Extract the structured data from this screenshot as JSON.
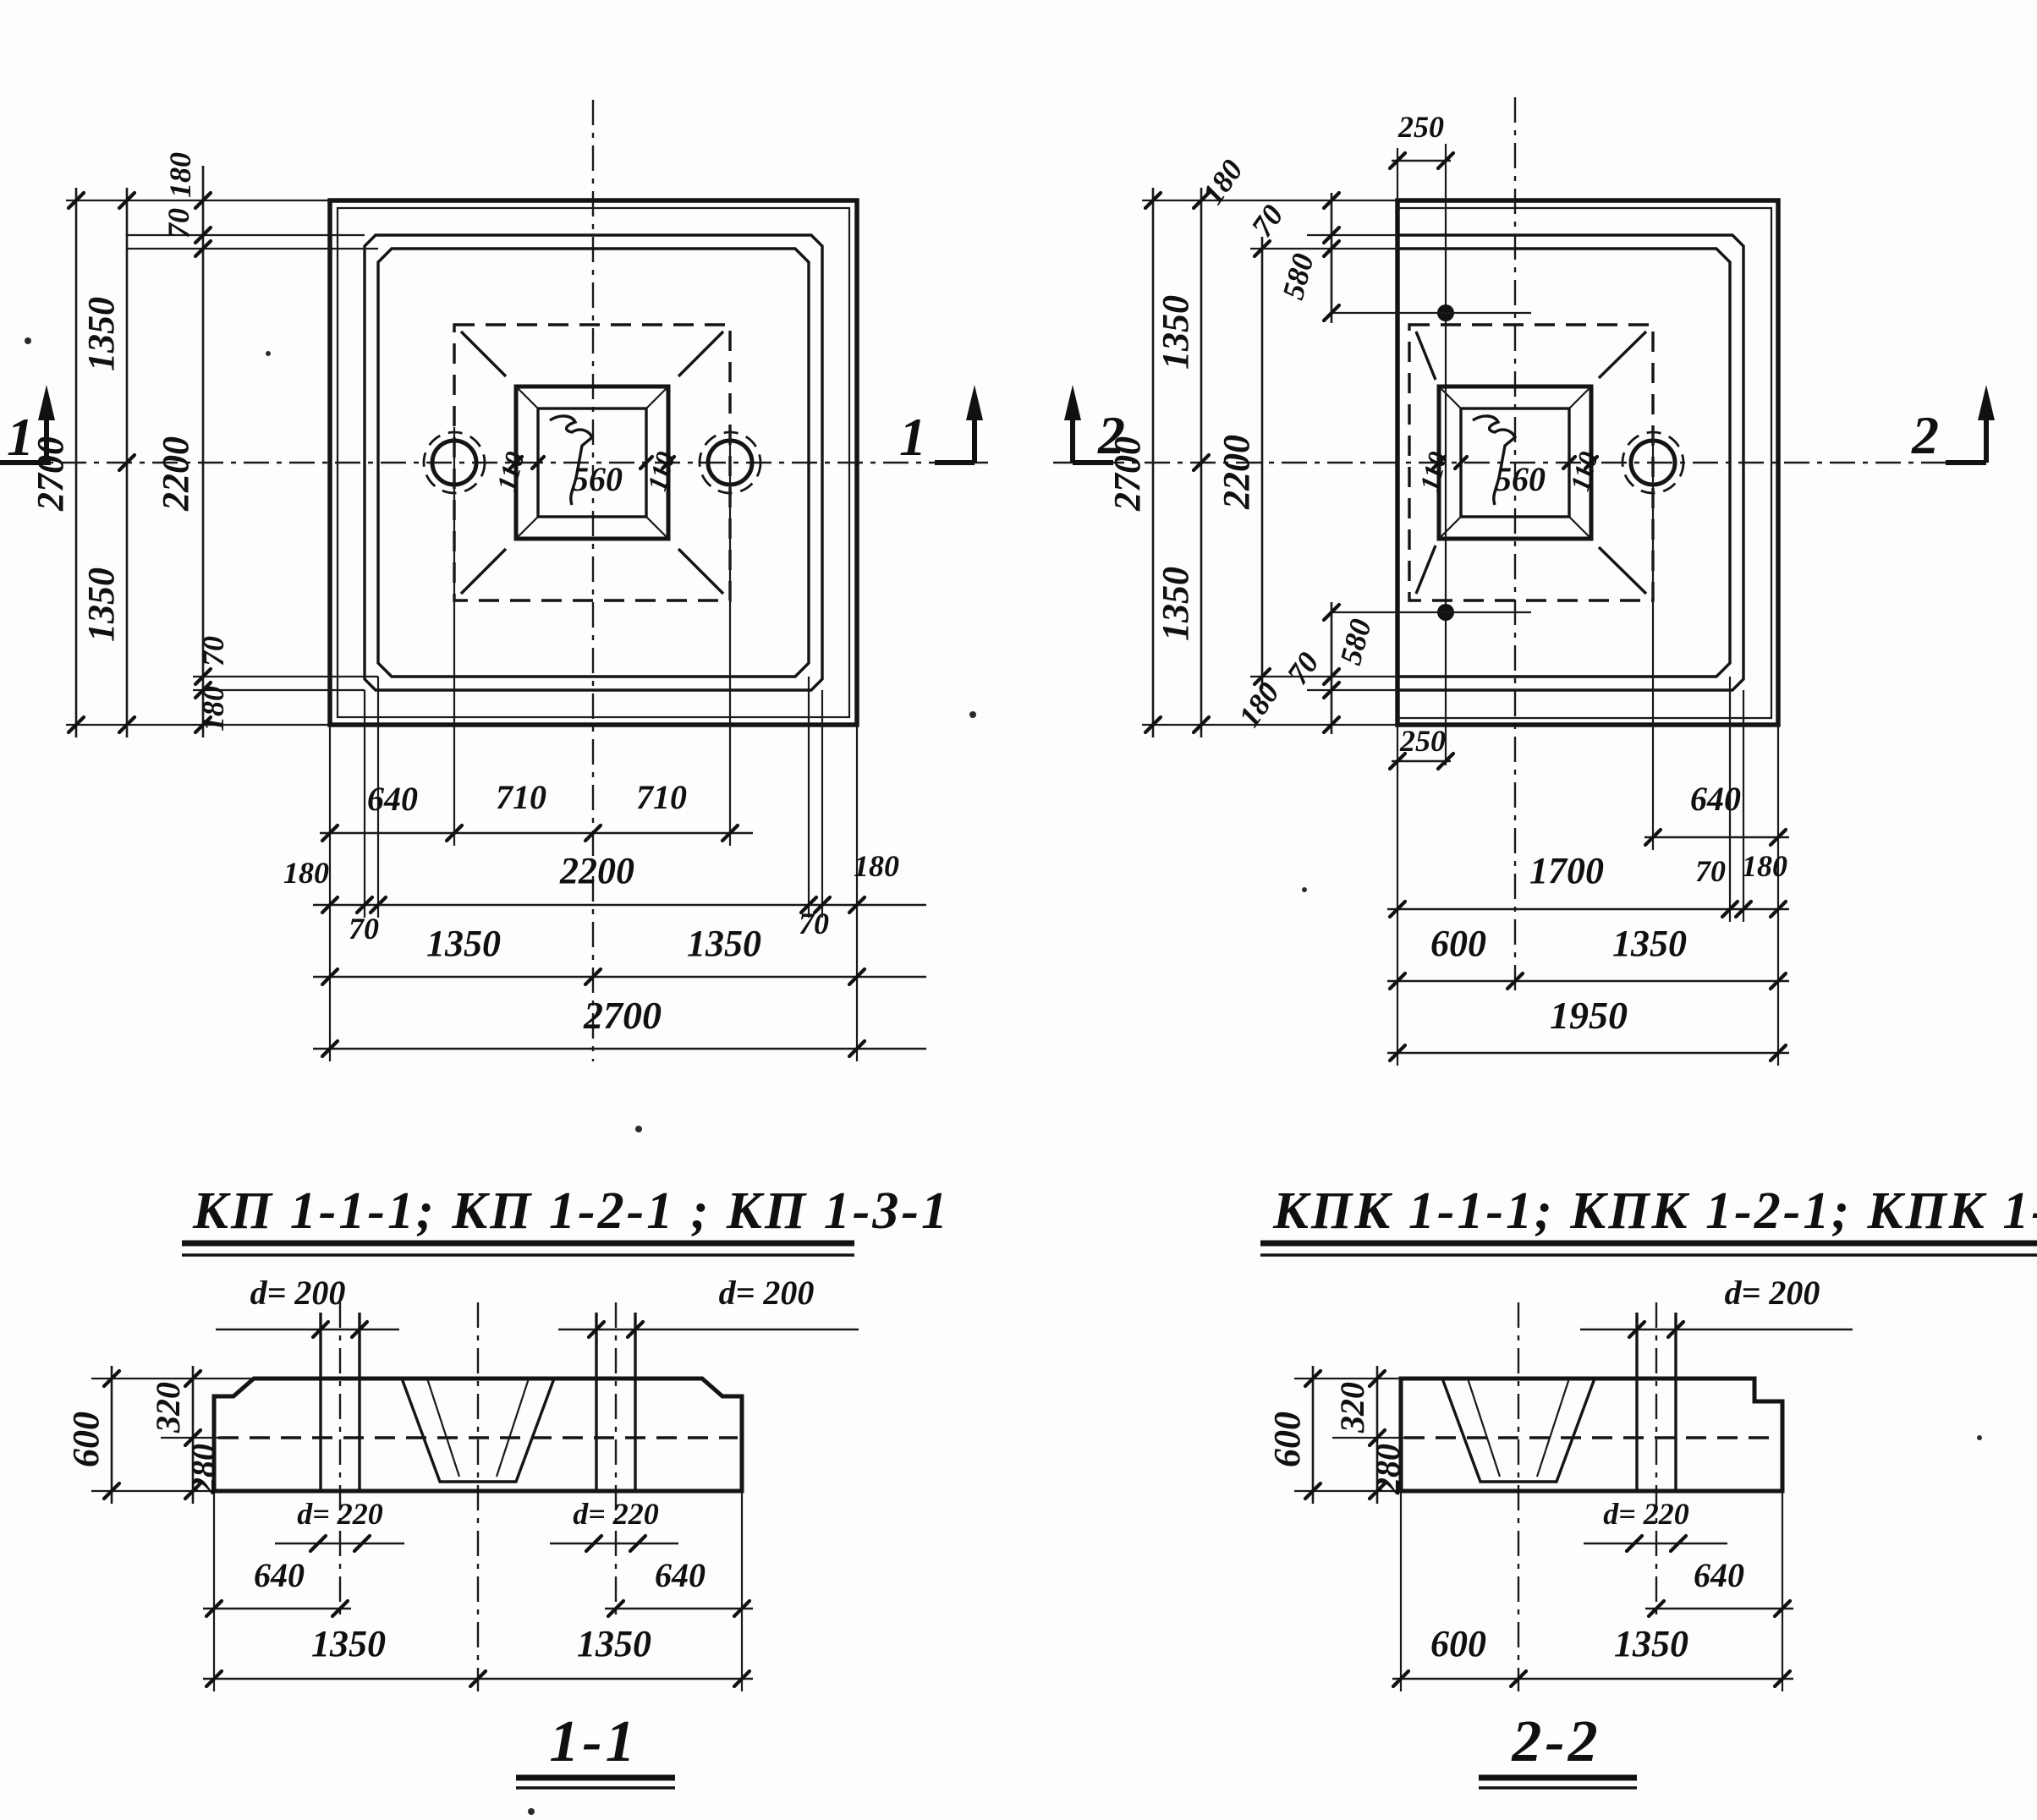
{
  "plan_left": {
    "title": "КП 1-1-1; КП 1-2-1 ; КП 1-3-1",
    "marker_left": "1",
    "marker_right": "1",
    "dims": {
      "overall_v": "2700",
      "half_top": "1350",
      "half_bottom": "1350",
      "edge_top": "180",
      "step_top": "70",
      "inner_v": "2200",
      "step_bottom": "70",
      "edge_bottom": "180",
      "wall_left": "110",
      "opening": "560",
      "wall_right": "110",
      "hole_edge": "640",
      "hole_to_center": "710",
      "center_to_hole": "710",
      "edge_left": "180",
      "inner_h": "2200",
      "edge_right": "180",
      "step_left": "70",
      "step_right": "70",
      "half_left": "1350",
      "half_right": "1350",
      "overall_h": "2700"
    }
  },
  "plan_right": {
    "title": "КПК 1-1-1; КПК 1-2-1; КПК 1-3-1",
    "marker_left": "2",
    "marker_right": "2",
    "dims": {
      "pin_offset_top": "250",
      "edge_diag_top": "180",
      "step_diag_top": "70",
      "pin_depth_top": "580",
      "overall_v": "2700",
      "half_top": "1350",
      "half_bottom": "1350",
      "inner_v": "2200",
      "pin_depth_bottom": "580",
      "step_diag_bottom": "70",
      "edge_diag_bottom": "180",
      "pin_offset_bottom": "250",
      "wall_left": "110",
      "opening": "560",
      "wall_right": "110",
      "hole_edge": "640",
      "inner_h": "1700",
      "step_right": "70",
      "edge_right": "180",
      "cut_offset": "600",
      "half_right": "1350",
      "overall_h": "1950"
    }
  },
  "section_1": {
    "title": "1-1",
    "pipe_d_left": "d= 200",
    "pipe_d_right": "d= 200",
    "hole_d_left": "d= 220",
    "hole_d_right": "d= 220",
    "height": "600",
    "height_top": "320",
    "height_bottom": "280",
    "hole_edge_left": "640",
    "hole_edge_right": "640",
    "half_left": "1350",
    "half_right": "1350"
  },
  "section_2": {
    "title": "2-2",
    "pipe_d": "d= 200",
    "hole_d": "d= 220",
    "height": "600",
    "height_top": "320",
    "height_bottom": "280",
    "hole_edge": "640",
    "cut_offset": "600",
    "half_right": "1350"
  }
}
